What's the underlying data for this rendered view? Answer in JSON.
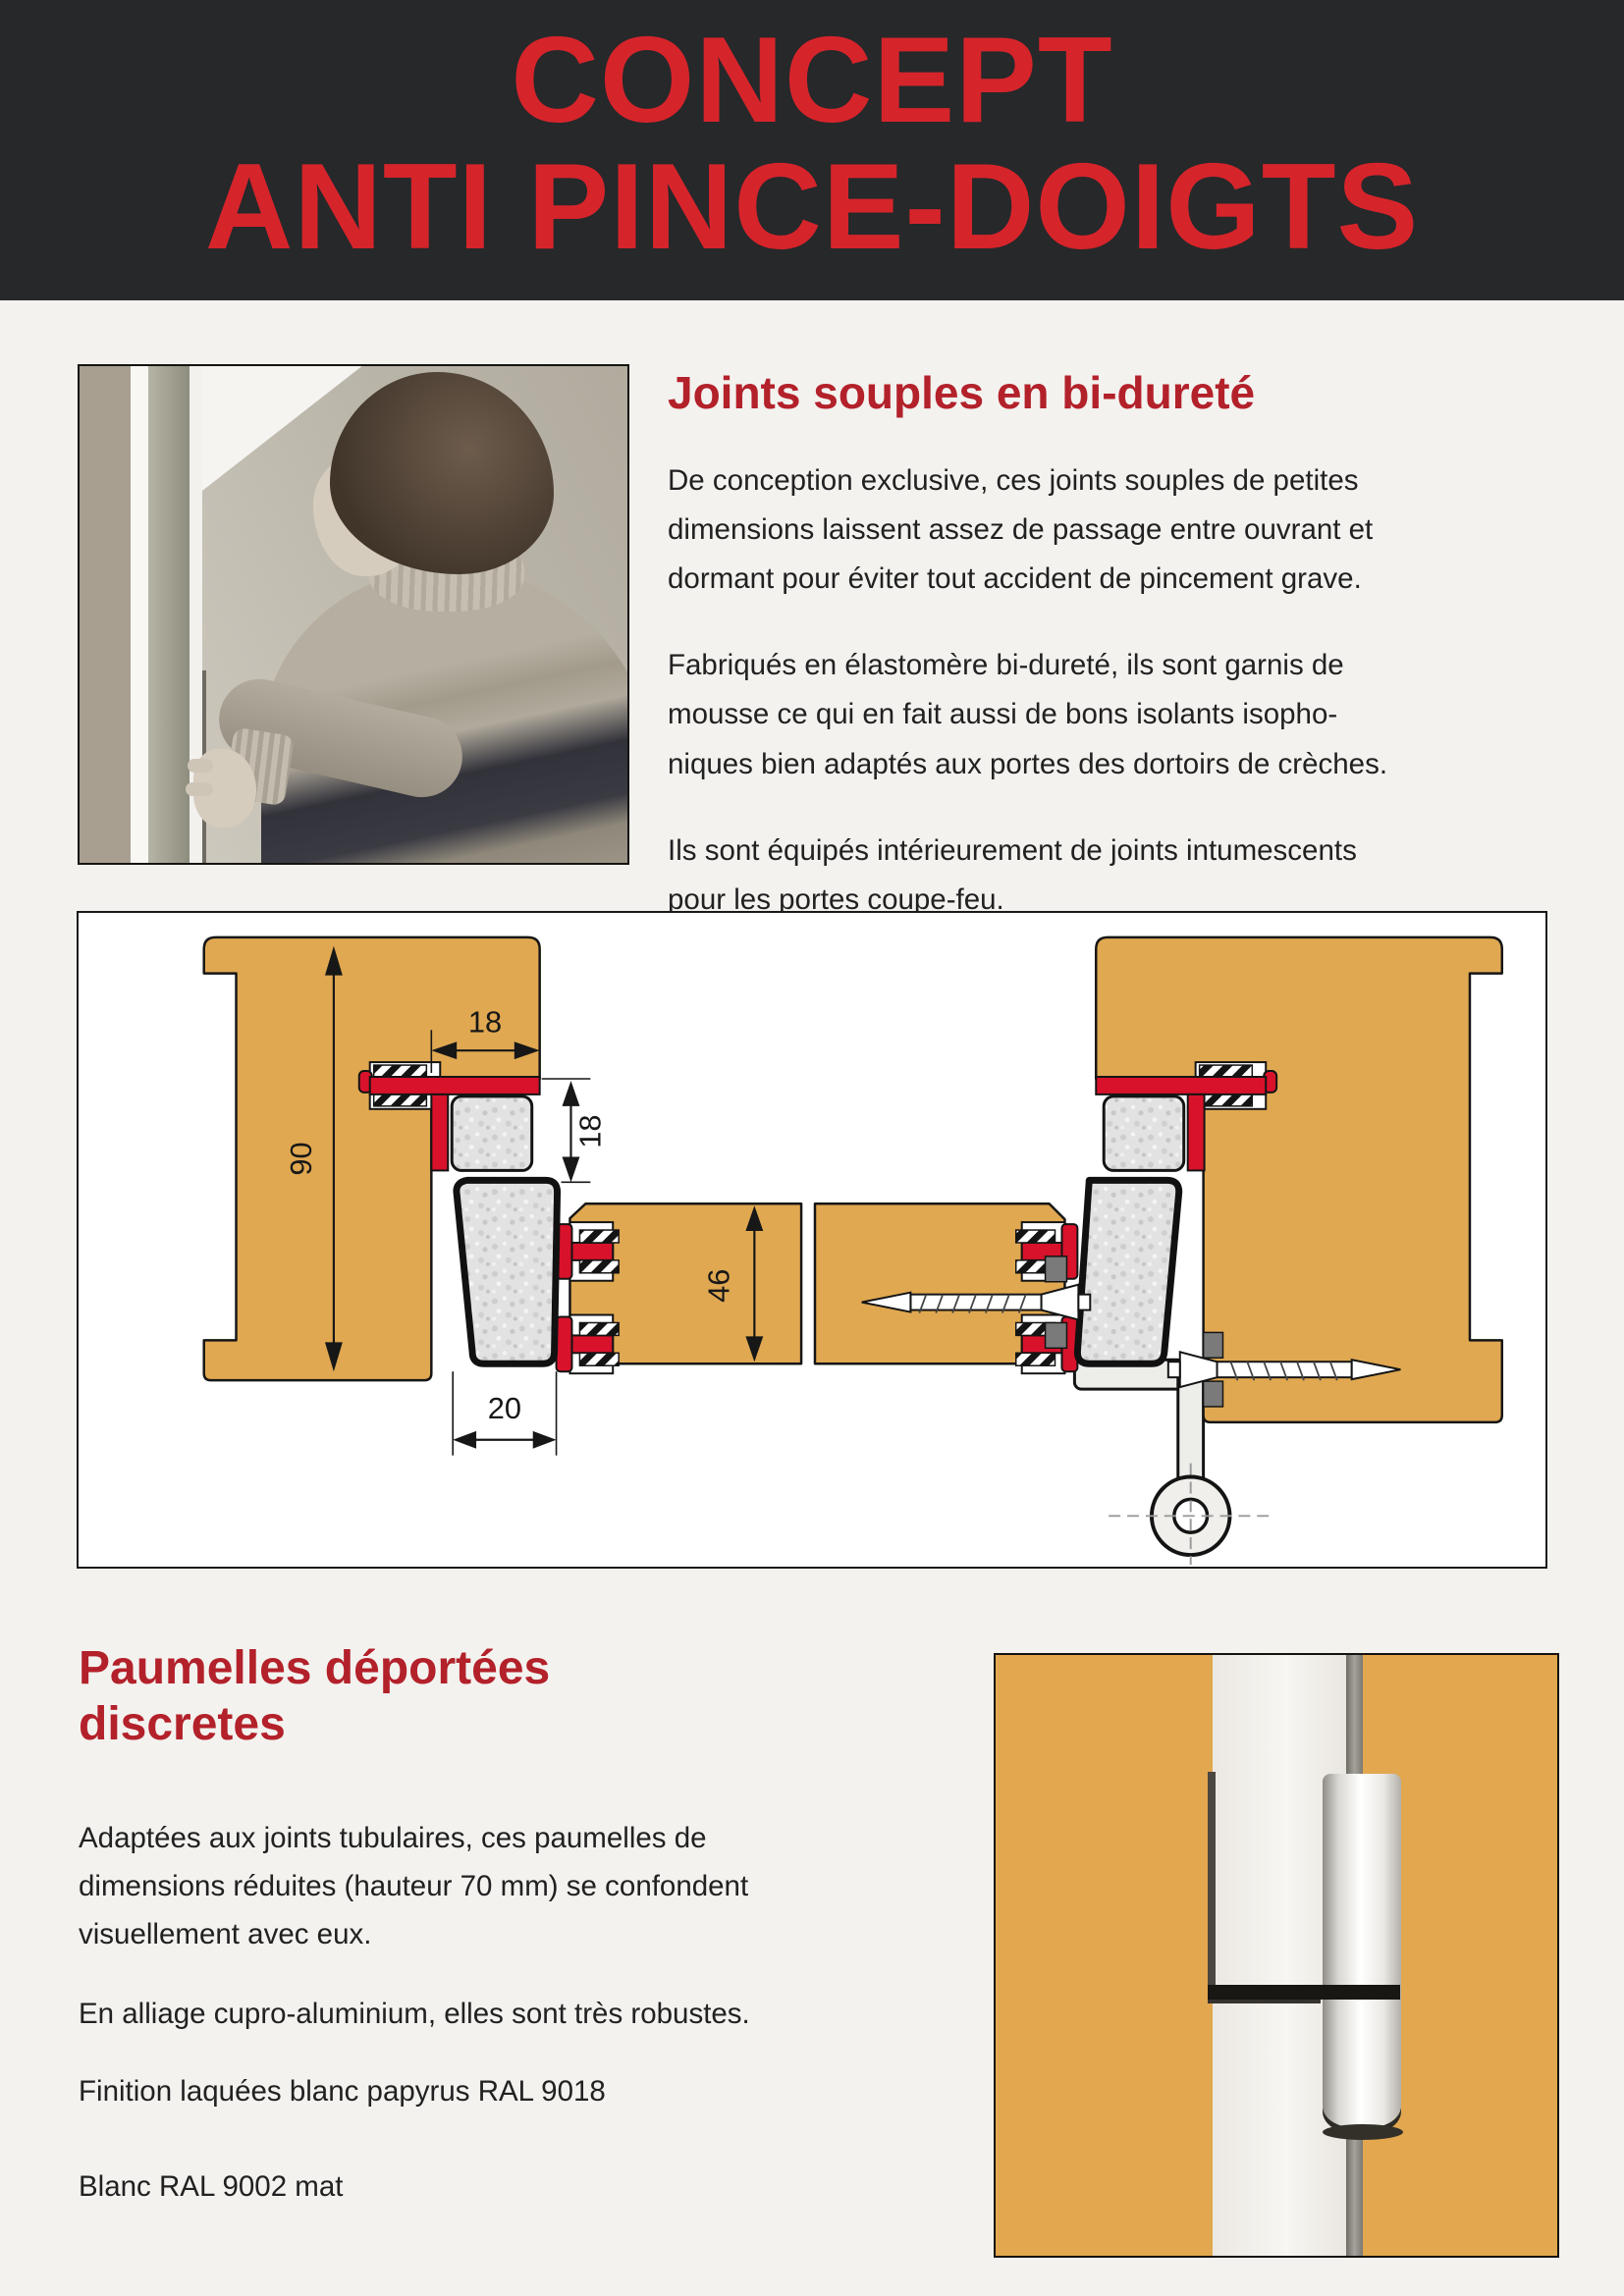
{
  "header": {
    "title_line1": "CONCEPT",
    "title_line2": "ANTI PINCE-DOIGTS"
  },
  "joints_section": {
    "heading": "Joints souples en bi-dureté",
    "paragraphs": [
      "De conception exclusive, ces joints souples de petites dimensions laissent assez de passage entre ouvrant et dormant pour éviter tout accident de pincement grave.",
      "Fabriqués en élastomère bi-dureté, ils sont garnis de mousse ce qui en fait aussi de bons isolants isopho-niques bien adaptés aux portes des dortoirs de crèches.",
      "Ils sont équipés intérieurement de joints intumescents pour les portes coupe-feu."
    ]
  },
  "diagram": {
    "dims": {
      "frame_depth": "90",
      "rebate_width": "18",
      "overlap": "18",
      "leaf_thickness": "46",
      "joint_width": "20"
    }
  },
  "paumelles_section": {
    "heading_line1": "Paumelles déportées",
    "heading_line2": "discretes",
    "paragraphs": [
      "Adaptées aux joints tubulaires, ces paumelles de dimensions réduites (hauteur 70 mm) se confondent visuellement avec eux.",
      "En alliage cupro-aluminium, elles sont très robustes.",
      "Finition laquées blanc papyrus RAL 9018",
      "Blanc RAL 9002 mat"
    ]
  },
  "colors": {
    "banner_background": "#26282a",
    "banner_title_red": "#d6242b",
    "section_heading_red": "#b3212a",
    "wood": "#e0a851",
    "gasket_red": "#d8122b",
    "page_background": "#f3f2ef"
  }
}
